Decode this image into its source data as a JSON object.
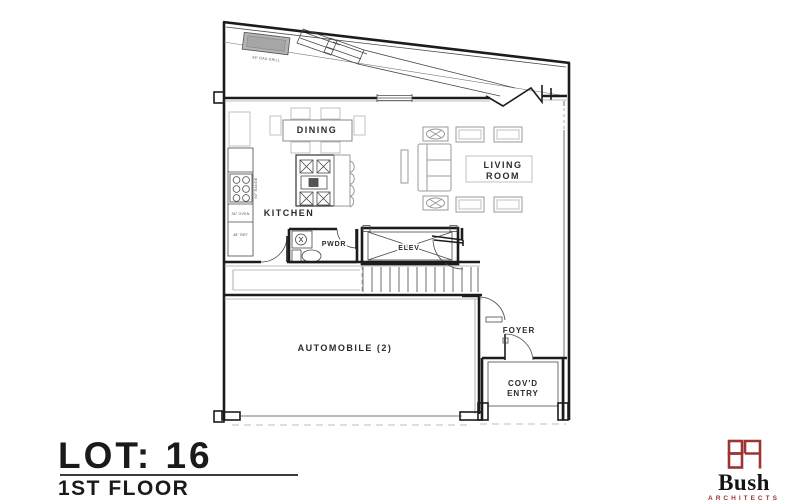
{
  "plan": {
    "dining": "DINING",
    "kitchen": "KITCHEN",
    "living_1": "LIVING",
    "living_2": "ROOM",
    "pwdr": "PWDR",
    "elev": "ELEV",
    "automobile": "AUTOMOBILE (2)",
    "foyer": "FOYER",
    "covd_1": "COV'D",
    "covd_2": "ENTRY",
    "grill_note": "36\" GAS GRILL",
    "oven_note": "36\" OVEN",
    "ref_note": "48\" REF",
    "range_note": "60\" RANGE"
  },
  "title_block": {
    "lot": "LOT: 16",
    "floor": "1ST FLOOR"
  },
  "logo": {
    "name": "Bush",
    "subtitle": "ARCHITECTS",
    "monogram": "BA"
  },
  "colors": {
    "background": "#ffffff",
    "wall_line": "#1c1c1c",
    "furniture_line": "#9a9a9a",
    "logo_accent": "#9d3332",
    "title_text": "#1a1a1a"
  }
}
